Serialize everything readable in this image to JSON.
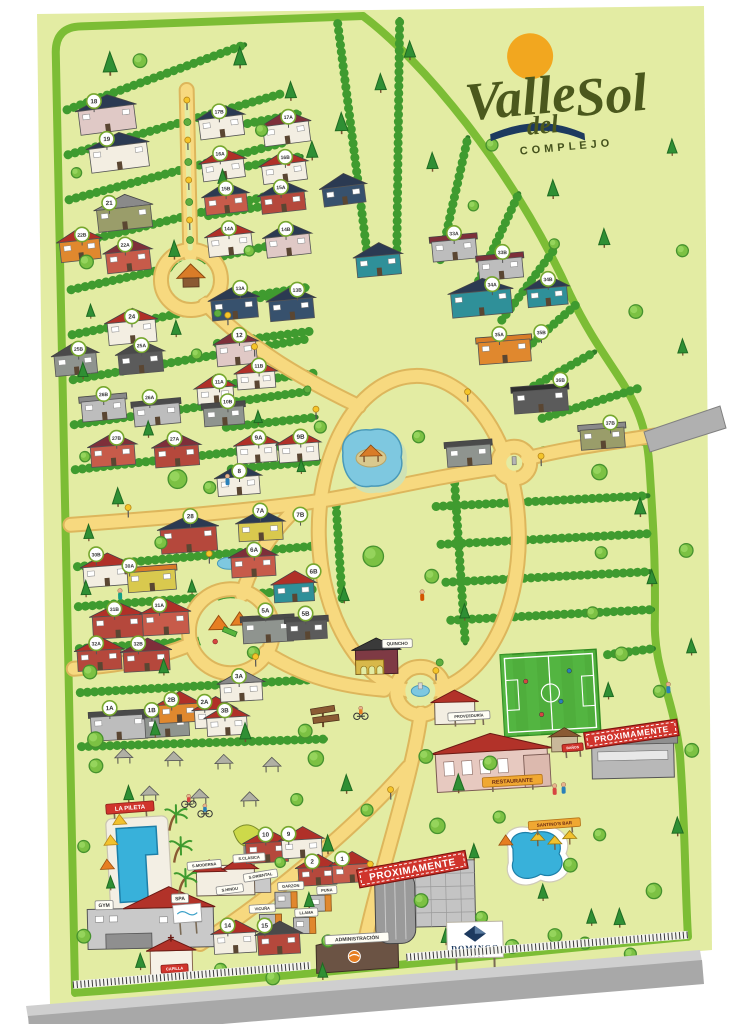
{
  "logo": {
    "w1": "Valle",
    "w2": "del",
    "w3": "Sol",
    "sub": "COMPLEJO"
  },
  "hotel_sign": {
    "name": "DOMINGO",
    "sub": "HOTEL"
  },
  "colors": {
    "sheet": "#e3eca3",
    "border": "#7cbd35",
    "hedge": "#2e7d28",
    "hedge_bump": "#3f9b2f",
    "road": "#f7d97f",
    "road_edge": "#ddb65c",
    "water": "#38b1da",
    "water_light": "#7ec8e0",
    "field": "#4fae3c",
    "banner": "#d0342c",
    "sun": "#f2a71f",
    "logo_green": "#4b581d",
    "navy": "#1d3a5f"
  },
  "banners": [
    {
      "t": "PROXIMAMENTE",
      "x": 404,
      "y": 870,
      "rot": -9,
      "w": 110,
      "fs": 10
    },
    {
      "t": "PROXIMAMENTE",
      "x": 626,
      "y": 740,
      "rot": -7,
      "w": 94,
      "fs": 8.5
    }
  ],
  "signs": [
    {
      "t": "LA PILETA",
      "x": 123,
      "y": 802,
      "style": "red",
      "w": 48,
      "fs": 6,
      "rot": -3,
      "post": true
    },
    {
      "t": "GYM",
      "x": 95,
      "y": 899,
      "style": "chip",
      "w": 18,
      "fs": 5,
      "rot": 0
    },
    {
      "t": "SPA",
      "x": 171,
      "y": 894,
      "style": "chip",
      "w": 17,
      "fs": 5,
      "rot": 0
    },
    {
      "t": "CAPILLA",
      "x": 164,
      "y": 964,
      "style": "red",
      "w": 27,
      "fs": 4,
      "rot": -2
    },
    {
      "t": "S.MODERNA",
      "x": 196,
      "y": 861,
      "style": "chip",
      "w": 34,
      "fs": 4,
      "rot": -4
    },
    {
      "t": "S.CLASICA",
      "x": 241,
      "y": 855,
      "style": "chip",
      "w": 32,
      "fs": 4,
      "rot": -3
    },
    {
      "t": "S.HINDU",
      "x": 221,
      "y": 886,
      "style": "chip",
      "w": 27,
      "fs": 4,
      "rot": -6
    },
    {
      "t": "S.ORIENTAL",
      "x": 252,
      "y": 873,
      "style": "chip",
      "w": 34,
      "fs": 4,
      "rot": -8
    },
    {
      "t": "GARZON",
      "x": 282,
      "y": 884,
      "style": "chip",
      "w": 26,
      "fs": 4,
      "rot": -2
    },
    {
      "t": "PUNA",
      "x": 318,
      "y": 889,
      "style": "chip",
      "w": 20,
      "fs": 4,
      "rot": -2
    },
    {
      "t": "VICUÑA",
      "x": 253,
      "y": 906,
      "style": "chip",
      "w": 26,
      "fs": 4,
      "rot": -2
    },
    {
      "t": "LLAMA",
      "x": 297,
      "y": 911,
      "style": "chip",
      "w": 23,
      "fs": 4,
      "rot": -2
    },
    {
      "t": "RESTAURANTE",
      "x": 506,
      "y": 784,
      "style": "orange",
      "w": 60,
      "fs": 5.5,
      "rot": -2,
      "post": true
    },
    {
      "t": "PROVEEDURÍA",
      "x": 464,
      "y": 718,
      "style": "chip",
      "w": 42,
      "fs": 4,
      "rot": -2,
      "post": true
    },
    {
      "t": "BAÑOS",
      "x": 567,
      "y": 752,
      "style": "red",
      "w": 21,
      "fs": 3.5,
      "rot": -4,
      "post": true
    },
    {
      "t": "SANTINO'S BAR",
      "x": 547,
      "y": 828,
      "style": "orange",
      "w": 52,
      "fs": 4.5,
      "rot": -3,
      "post": true
    },
    {
      "t": "QUINCHO",
      "x": 394,
      "y": 644,
      "style": "chip",
      "w": 30,
      "fs": 4.5,
      "rot": 0
    },
    {
      "t": "ADMINISTRACIÓN",
      "x": 347,
      "y": 938,
      "style": "chip",
      "w": 64,
      "fs": 5,
      "rot": -2
    }
  ],
  "badges": [
    [
      "18",
      103,
      95
    ],
    [
      "19",
      115,
      133
    ],
    [
      "21",
      116,
      197
    ],
    [
      "22B",
      88,
      228
    ],
    [
      "22A",
      131,
      239
    ],
    [
      "24",
      136,
      311
    ],
    [
      "25B",
      82,
      342
    ],
    [
      "25A",
      145,
      340
    ],
    [
      "26B",
      106,
      388
    ],
    [
      "26A",
      152,
      392
    ],
    [
      "27B",
      118,
      432
    ],
    [
      "27A",
      176,
      434
    ],
    [
      "28",
      190,
      512
    ],
    [
      "30B",
      95,
      548
    ],
    [
      "30A",
      128,
      560
    ],
    [
      "31B",
      112,
      603
    ],
    [
      "31A",
      157,
      600
    ],
    [
      "32A",
      93,
      637
    ],
    [
      "32B",
      135,
      638
    ],
    [
      "1A",
      105,
      702
    ],
    [
      "1B",
      147,
      705
    ],
    [
      "2B",
      167,
      695
    ],
    [
      "2A",
      200,
      698
    ],
    [
      "3A",
      235,
      673
    ],
    [
      "3B",
      220,
      707
    ],
    [
      "17B",
      228,
      108
    ],
    [
      "17A",
      297,
      115
    ],
    [
      "16A",
      228,
      150
    ],
    [
      "16B",
      293,
      155
    ],
    [
      "15B",
      233,
      185
    ],
    [
      "15A",
      288,
      185
    ],
    [
      "14A",
      235,
      225
    ],
    [
      "14B",
      292,
      227
    ],
    [
      "13A",
      245,
      285
    ],
    [
      "13B",
      302,
      288
    ],
    [
      "12",
      243,
      332
    ],
    [
      "11B",
      262,
      363
    ],
    [
      "11A",
      222,
      378
    ],
    [
      "10B",
      230,
      398
    ],
    [
      "9A",
      260,
      435
    ],
    [
      "9B",
      302,
      435
    ],
    [
      "8",
      240,
      468
    ],
    [
      "7A",
      260,
      508
    ],
    [
      "7B",
      300,
      513
    ],
    [
      "6A",
      253,
      547
    ],
    [
      "6B",
      312,
      570
    ],
    [
      "5A",
      263,
      608
    ],
    [
      "5B",
      303,
      612
    ],
    [
      "33A",
      460,
      235
    ],
    [
      "33B",
      508,
      255
    ],
    [
      "34A",
      497,
      287
    ],
    [
      "34B",
      553,
      283
    ],
    [
      "35A",
      503,
      337
    ],
    [
      "35B",
      545,
      336
    ],
    [
      "36B",
      563,
      384
    ],
    [
      "37B",
      612,
      428
    ],
    [
      "10",
      258,
      832
    ],
    [
      "9",
      281,
      832
    ],
    [
      "2",
      304,
      860
    ],
    [
      "1",
      334,
      858
    ],
    [
      "14",
      218,
      922
    ],
    [
      "15",
      255,
      923
    ]
  ],
  "houses": [
    [
      88,
      102,
      56,
      24,
      "w10",
      "r1",
      -6,
      0
    ],
    [
      98,
      140,
      58,
      24,
      "w1",
      "r1",
      -6,
      0
    ],
    [
      104,
      202,
      54,
      22,
      "w11",
      "r6",
      -5,
      0
    ],
    [
      66,
      234,
      40,
      20,
      "w6",
      "r2",
      -5,
      0
    ],
    [
      112,
      246,
      44,
      20,
      "w5",
      "r4",
      -5,
      0
    ],
    [
      112,
      316,
      48,
      22,
      "w1",
      "r2",
      -4,
      0
    ],
    [
      58,
      348,
      42,
      20,
      "w3",
      "r3",
      -4,
      0
    ],
    [
      122,
      348,
      44,
      20,
      "w12",
      "r3",
      -4,
      0
    ],
    [
      84,
      394,
      44,
      20,
      "w2",
      "r6",
      -4,
      1
    ],
    [
      136,
      400,
      46,
      20,
      "w2",
      "r3",
      -4,
      1
    ],
    [
      92,
      440,
      44,
      20,
      "w5",
      "r4",
      -3,
      0
    ],
    [
      156,
      442,
      44,
      20,
      "w4",
      "r4",
      -3,
      0
    ],
    [
      160,
      524,
      56,
      24,
      "w4",
      "r1",
      -3,
      0
    ],
    [
      82,
      560,
      46,
      20,
      "w1",
      "r2",
      -3,
      0
    ],
    [
      126,
      566,
      48,
      20,
      "w7",
      "r5",
      -3,
      1
    ],
    [
      90,
      610,
      50,
      22,
      "w4",
      "r2",
      -2,
      0
    ],
    [
      140,
      608,
      46,
      22,
      "w5",
      "r2",
      -2,
      0
    ],
    [
      74,
      644,
      44,
      20,
      "w4",
      "r2",
      -2,
      0
    ],
    [
      120,
      646,
      46,
      20,
      "w4",
      "r4",
      -2,
      0
    ],
    [
      86,
      710,
      56,
      24,
      "w2",
      "r3",
      -2,
      1
    ],
    [
      140,
      712,
      44,
      20,
      "w3",
      "r3",
      -2,
      1
    ],
    [
      154,
      700,
      40,
      18,
      "w6",
      "r2",
      -2,
      0
    ],
    [
      190,
      706,
      40,
      18,
      "w1",
      "r2",
      -2,
      0
    ],
    [
      216,
      680,
      42,
      18,
      "w1",
      "r6",
      -2,
      0
    ],
    [
      202,
      714,
      40,
      18,
      "w1",
      "r2",
      -2,
      0
    ],
    [
      208,
      114,
      44,
      20,
      "w1",
      "r1",
      -6,
      0
    ],
    [
      272,
      122,
      46,
      20,
      "w1",
      "r4",
      -6,
      0
    ],
    [
      210,
      158,
      42,
      18,
      "w1",
      "r2",
      -6,
      0
    ],
    [
      270,
      162,
      44,
      18,
      "w1",
      "r2",
      -6,
      0
    ],
    [
      212,
      192,
      42,
      18,
      "w5",
      "r1",
      -5,
      0
    ],
    [
      268,
      192,
      44,
      18,
      "w4",
      "r1",
      -5,
      0
    ],
    [
      214,
      232,
      44,
      20,
      "w1",
      "r2",
      -5,
      0
    ],
    [
      272,
      234,
      44,
      20,
      "w10",
      "r1",
      -5,
      0
    ],
    [
      216,
      296,
      46,
      20,
      "w8",
      "r1",
      -4,
      0
    ],
    [
      274,
      298,
      44,
      20,
      "w8",
      "r1",
      -4,
      0
    ],
    [
      220,
      340,
      40,
      22,
      "w10",
      "r4",
      -4,
      0
    ],
    [
      240,
      370,
      38,
      16,
      "w1",
      "r2",
      -3,
      0
    ],
    [
      200,
      384,
      36,
      16,
      "w1",
      "r2",
      -3,
      0
    ],
    [
      206,
      404,
      40,
      18,
      "w3",
      "r3",
      -3,
      1
    ],
    [
      238,
      442,
      40,
      18,
      "w1",
      "r2",
      -3,
      0
    ],
    [
      280,
      442,
      40,
      18,
      "w1",
      "r2",
      -3,
      0
    ],
    [
      218,
      474,
      42,
      18,
      "w1",
      "r1",
      -3,
      0
    ],
    [
      238,
      520,
      44,
      18,
      "w7",
      "r1",
      -2,
      0
    ],
    [
      258,
      540,
      0,
      0,
      "w7",
      "r5",
      0,
      0
    ],
    [
      230,
      554,
      44,
      20,
      "w5",
      "r4",
      -2,
      0
    ],
    [
      272,
      582,
      40,
      18,
      "w9",
      "r2",
      -2,
      0
    ],
    [
      240,
      618,
      50,
      22,
      "w3",
      "r3",
      -2,
      1
    ],
    [
      284,
      620,
      40,
      18,
      "w12",
      "r3",
      -2,
      1
    ],
    [
      438,
      242,
      44,
      20,
      "w2",
      "r4",
      -4,
      1
    ],
    [
      484,
      262,
      44,
      20,
      "w2",
      "r4",
      -4,
      1
    ],
    [
      456,
      294,
      60,
      24,
      "w9",
      "r1",
      -4,
      0
    ],
    [
      532,
      292,
      40,
      18,
      "w9",
      "r1",
      -4,
      0
    ],
    [
      482,
      344,
      52,
      22,
      "w6",
      "r5",
      -3,
      1
    ],
    [
      516,
      394,
      54,
      22,
      "w12",
      "r7",
      -3,
      1
    ],
    [
      582,
      434,
      44,
      20,
      "w11",
      "r6",
      -3,
      1
    ],
    [
      330,
      186,
      42,
      18,
      "w8",
      "r1",
      -6,
      0
    ],
    [
      362,
      256,
      44,
      20,
      "w9",
      "r1",
      -4,
      0
    ],
    [
      448,
      448,
      44,
      20,
      "w3",
      "r3",
      -3,
      1
    ],
    [
      238,
      840,
      42,
      20,
      "w4",
      "r2",
      -2,
      0
    ],
    [
      274,
      838,
      40,
      18,
      "w1",
      "r2",
      -2,
      0
    ],
    [
      290,
      866,
      38,
      18,
      "w4",
      "r2",
      -2,
      0
    ],
    [
      324,
      864,
      38,
      18,
      "w5",
      "r2",
      -2,
      0
    ],
    [
      204,
      930,
      42,
      20,
      "w1",
      "r2",
      -2,
      0
    ],
    [
      248,
      932,
      42,
      20,
      "w4",
      "r3",
      -2,
      0
    ]
  ],
  "trees": [
    [
      120,
      66,
      "p",
      1
    ],
    [
      150,
      58,
      "r",
      0.8
    ],
    [
      250,
      62,
      "p",
      0.9
    ],
    [
      300,
      96,
      "p",
      0.8
    ],
    [
      270,
      130,
      "r",
      0.7
    ],
    [
      320,
      156,
      "p",
      0.8
    ],
    [
      84,
      168,
      "r",
      0.6
    ],
    [
      230,
      180,
      "p",
      0.7
    ],
    [
      180,
      252,
      "p",
      0.8
    ],
    [
      92,
      258,
      "r",
      0.8
    ],
    [
      255,
      250,
      "r",
      0.6
    ],
    [
      95,
      310,
      "p",
      0.6
    ],
    [
      180,
      330,
      "p",
      0.7
    ],
    [
      86,
      370,
      "p",
      0.7
    ],
    [
      200,
      352,
      "r",
      0.6
    ],
    [
      150,
      430,
      "p",
      0.7
    ],
    [
      86,
      452,
      "r",
      0.6
    ],
    [
      260,
      420,
      "p",
      0.6
    ],
    [
      178,
      478,
      "r",
      1.1
    ],
    [
      118,
      498,
      "p",
      0.8
    ],
    [
      210,
      486,
      "r",
      0.7
    ],
    [
      88,
      532,
      "p",
      0.7
    ],
    [
      160,
      540,
      "r",
      0.7
    ],
    [
      84,
      588,
      "p",
      0.7
    ],
    [
      190,
      588,
      "p",
      0.6
    ],
    [
      86,
      668,
      "r",
      0.8
    ],
    [
      160,
      668,
      "p",
      0.7
    ],
    [
      250,
      652,
      "r",
      0.7
    ],
    [
      90,
      736,
      "r",
      0.9
    ],
    [
      150,
      730,
      "p",
      0.7
    ],
    [
      240,
      736,
      "p",
      0.8
    ],
    [
      300,
      732,
      "r",
      0.8
    ],
    [
      350,
      130,
      "p",
      0.9
    ],
    [
      390,
      90,
      "p",
      0.8
    ],
    [
      420,
      58,
      "p",
      0.8
    ],
    [
      440,
      170,
      "p",
      0.8
    ],
    [
      500,
      150,
      "r",
      0.7
    ],
    [
      560,
      200,
      "p",
      0.8
    ],
    [
      610,
      250,
      "p",
      0.8
    ],
    [
      640,
      320,
      "r",
      0.8
    ],
    [
      560,
      250,
      "r",
      0.6
    ],
    [
      480,
      210,
      "r",
      0.6
    ],
    [
      600,
      480,
      "r",
      0.9
    ],
    [
      640,
      520,
      "p",
      0.8
    ],
    [
      600,
      560,
      "r",
      0.7
    ],
    [
      650,
      590,
      "p",
      0.7
    ],
    [
      590,
      620,
      "r",
      0.7
    ],
    [
      618,
      662,
      "r",
      0.8
    ],
    [
      655,
      700,
      "r",
      0.7
    ],
    [
      604,
      702,
      "p",
      0.7
    ],
    [
      680,
      160,
      "p",
      0.7
    ],
    [
      688,
      260,
      "r",
      0.7
    ],
    [
      686,
      360,
      "p",
      0.7
    ],
    [
      685,
      560,
      "r",
      0.8
    ],
    [
      688,
      660,
      "p",
      0.7
    ],
    [
      686,
      760,
      "r",
      0.8
    ],
    [
      670,
      840,
      "p",
      0.8
    ],
    [
      645,
      900,
      "r",
      0.9
    ],
    [
      610,
      930,
      "p",
      0.8
    ],
    [
      575,
      950,
      "r",
      0.7
    ],
    [
      322,
      428,
      "r",
      0.7
    ],
    [
      302,
      470,
      "p",
      0.6
    ],
    [
      420,
      440,
      "r",
      0.7
    ],
    [
      372,
      560,
      "r",
      1.2
    ],
    [
      342,
      600,
      "p",
      0.7
    ],
    [
      430,
      580,
      "r",
      0.8
    ],
    [
      462,
      620,
      "p",
      0.7
    ],
    [
      310,
      760,
      "r",
      0.9
    ],
    [
      340,
      790,
      "p",
      0.8
    ],
    [
      290,
      800,
      "r",
      0.7
    ],
    [
      360,
      812,
      "r",
      0.7
    ],
    [
      320,
      850,
      "p",
      0.8
    ],
    [
      420,
      760,
      "r",
      0.8
    ],
    [
      452,
      792,
      "p",
      0.8
    ],
    [
      484,
      768,
      "r",
      0.8
    ],
    [
      430,
      830,
      "r",
      0.9
    ],
    [
      466,
      860,
      "p",
      0.7
    ],
    [
      492,
      822,
      "r",
      0.7
    ],
    [
      412,
      904,
      "r",
      0.8
    ],
    [
      436,
      944,
      "p",
      0.7
    ],
    [
      472,
      922,
      "r",
      0.7
    ],
    [
      502,
      952,
      "r",
      0.8
    ],
    [
      534,
      902,
      "p",
      0.7
    ],
    [
      562,
      872,
      "r",
      0.8
    ],
    [
      592,
      842,
      "r",
      0.7
    ],
    [
      545,
      942,
      "r",
      0.8
    ],
    [
      582,
      928,
      "p",
      0.7
    ],
    [
      300,
      905,
      "p",
      0.7
    ],
    [
      272,
      862,
      "r",
      0.6
    ],
    [
      318,
      942,
      "r",
      0.7
    ],
    [
      90,
      762,
      "r",
      0.8
    ],
    [
      122,
      794,
      "p",
      0.7
    ],
    [
      76,
      842,
      "r",
      0.7
    ],
    [
      102,
      882,
      "p",
      0.6
    ],
    [
      74,
      932,
      "r",
      0.8
    ],
    [
      130,
      962,
      "p",
      0.7
    ],
    [
      262,
      978,
      "r",
      0.8
    ],
    [
      312,
      976,
      "p",
      0.7
    ],
    [
      210,
      968,
      "r",
      0.7
    ],
    [
      620,
      962,
      "r",
      0.7
    ],
    [
      162,
      826,
      "l",
      1
    ],
    [
      166,
      858,
      "l",
      1
    ],
    [
      170,
      890,
      "l",
      0.9
    ]
  ],
  "figures": [
    [
      182,
      800,
      "b",
      "#d64541"
    ],
    [
      198,
      810,
      "b",
      "#2980b9"
    ],
    [
      356,
      716,
      "b",
      "#e67e22"
    ],
    [
      548,
      797,
      "p",
      "#d64541"
    ],
    [
      557,
      796,
      "p",
      "#2980b9"
    ],
    [
      296,
      162,
      "p",
      "#b03a2a"
    ],
    [
      228,
      480,
      "p",
      "#2980b9"
    ],
    [
      420,
      600,
      "p",
      "#d35400"
    ],
    [
      118,
      592,
      "p",
      "#16a085"
    ],
    [
      664,
      698,
      "p",
      "#2980b9"
    ]
  ],
  "lamps": [
    [
      196,
      106
    ],
    [
      196,
      146
    ],
    [
      196,
      186
    ],
    [
      196,
      226
    ],
    [
      232,
      322
    ],
    [
      258,
      354
    ],
    [
      208,
      560
    ],
    [
      252,
      664
    ],
    [
      318,
      418
    ],
    [
      470,
      404
    ],
    [
      384,
      800
    ],
    [
      362,
      874
    ],
    [
      128,
      512
    ],
    [
      432,
      682
    ],
    [
      542,
      470
    ]
  ],
  "bushes": [
    [
      196,
      118
    ],
    [
      196,
      158
    ],
    [
      196,
      198
    ],
    [
      196,
      236
    ],
    [
      240,
      334
    ],
    [
      222,
      310
    ],
    [
      310,
      388
    ],
    [
      436,
      664
    ]
  ]
}
